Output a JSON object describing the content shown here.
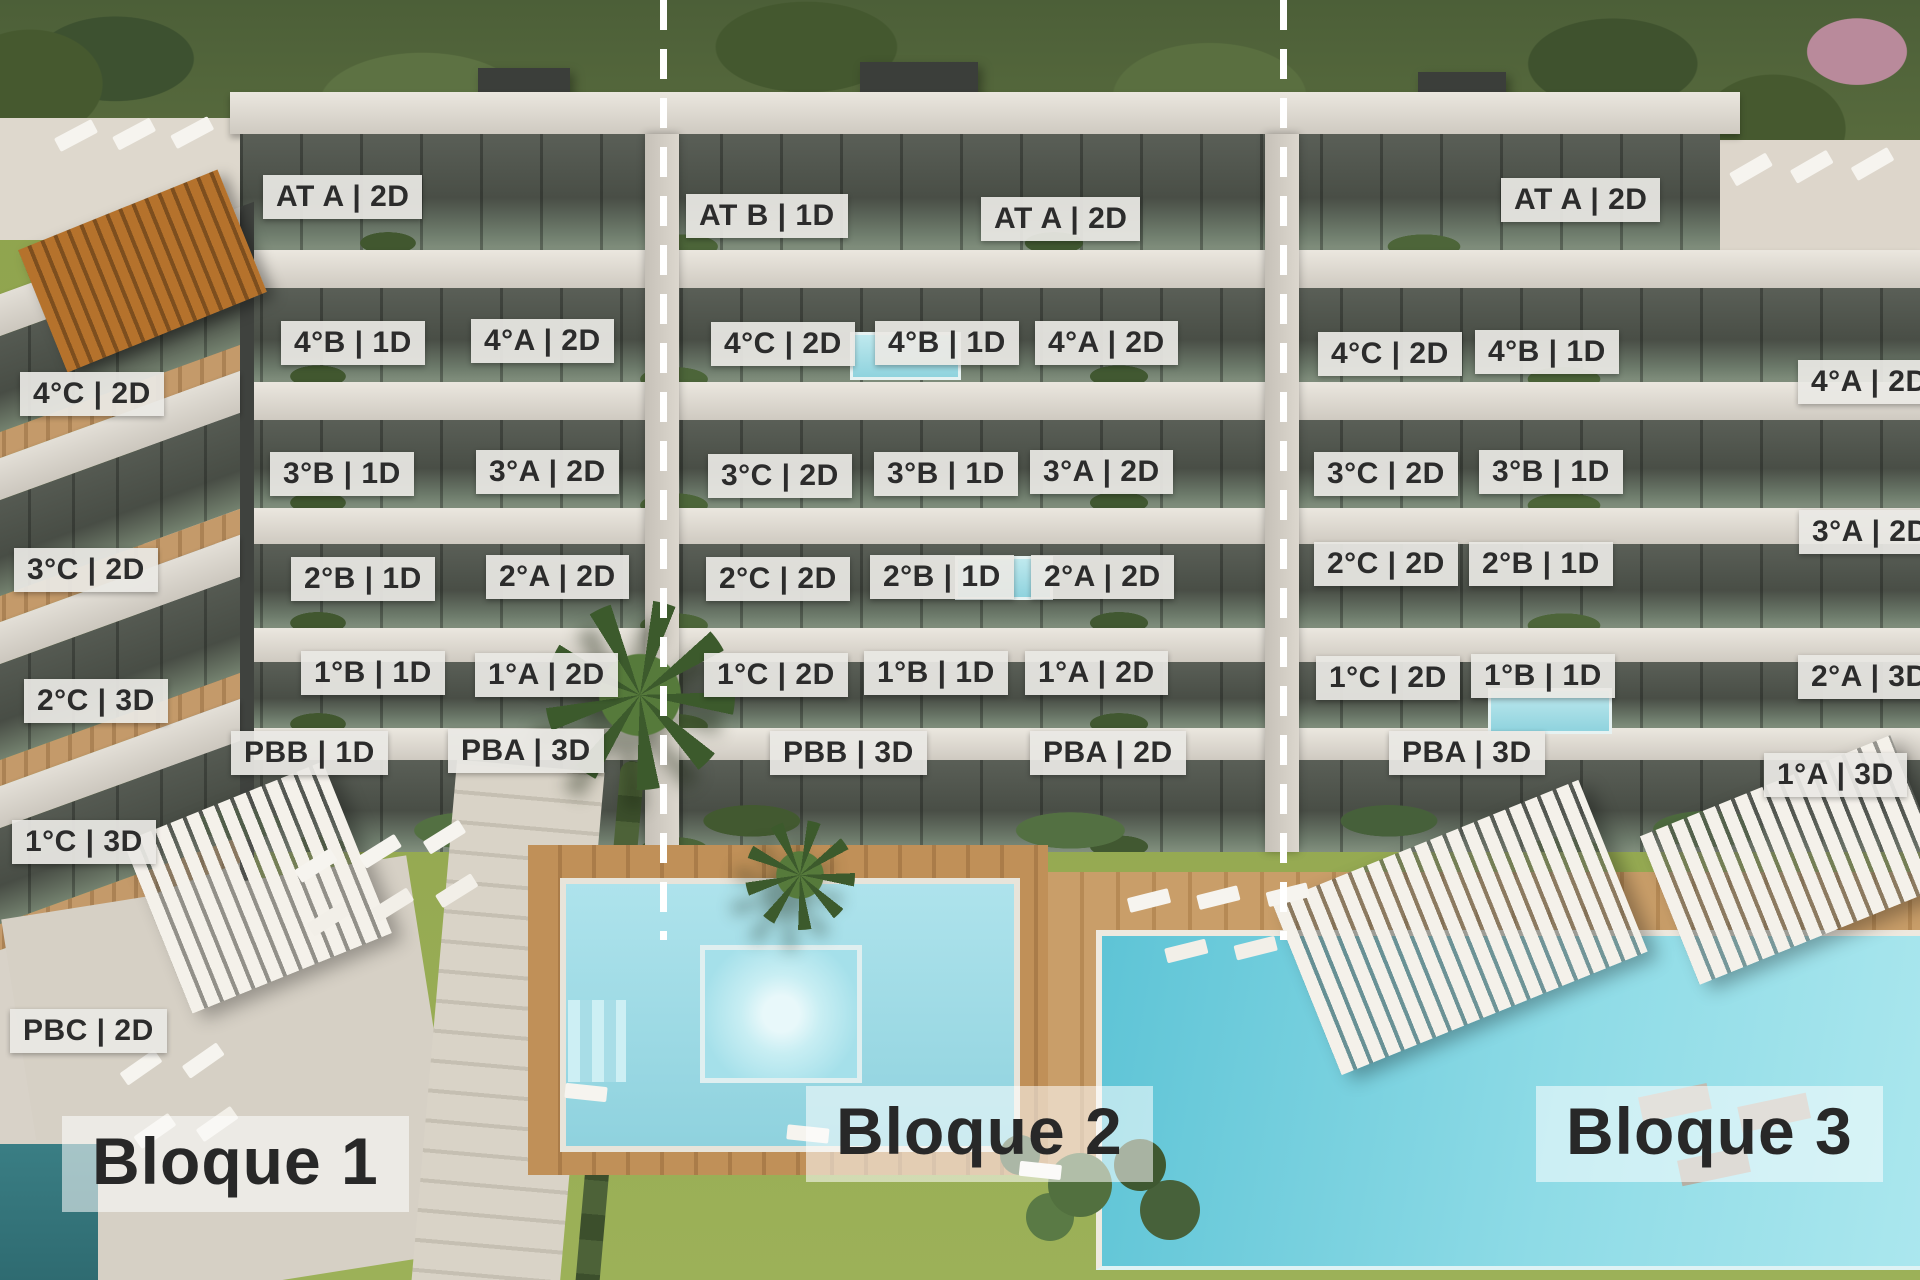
{
  "block_titles": [
    "Bloque 1",
    "Bloque 2",
    "Bloque 3"
  ],
  "colors": {
    "label_background": "#e9e8e4",
    "label_text": "#2c2c2c",
    "title_text": "#282828",
    "divider": "#ffffff",
    "lawn": "#93a750",
    "pool_water": "#8ed8e3",
    "wood_deck": "#bd8f5c",
    "facade_light": "#e2ded6",
    "facade_glass": "#4c5049"
  },
  "dividers": [
    {
      "x": 660
    },
    {
      "x": 1280
    }
  ],
  "unit_labels": [
    {
      "block": "Bloque 1",
      "text": "4°C | 2D",
      "x": 20,
      "y": 372
    },
    {
      "block": "Bloque 1",
      "text": "3°C | 2D",
      "x": 14,
      "y": 548
    },
    {
      "block": "Bloque 1",
      "text": "2°C | 3D",
      "x": 24,
      "y": 679
    },
    {
      "block": "Bloque 1",
      "text": "1°C | 3D",
      "x": 12,
      "y": 820
    },
    {
      "block": "Bloque 1",
      "text": "PBC | 2D",
      "x": 10,
      "y": 1009
    },
    {
      "block": "Bloque 1",
      "text": "AT A | 2D",
      "x": 263,
      "y": 175
    },
    {
      "block": "Bloque 1",
      "text": "4°B | 1D",
      "x": 281,
      "y": 321
    },
    {
      "block": "Bloque 1",
      "text": "4°A | 2D",
      "x": 471,
      "y": 319
    },
    {
      "block": "Bloque 1",
      "text": "3°B | 1D",
      "x": 270,
      "y": 452
    },
    {
      "block": "Bloque 1",
      "text": "3°A | 2D",
      "x": 476,
      "y": 450
    },
    {
      "block": "Bloque 1",
      "text": "2°B | 1D",
      "x": 291,
      "y": 557
    },
    {
      "block": "Bloque 1",
      "text": "2°A | 2D",
      "x": 486,
      "y": 555
    },
    {
      "block": "Bloque 1",
      "text": "1°B | 1D",
      "x": 301,
      "y": 651
    },
    {
      "block": "Bloque 1",
      "text": "1°A | 2D",
      "x": 475,
      "y": 653
    },
    {
      "block": "Bloque 1",
      "text": "PBB | 1D",
      "x": 231,
      "y": 731
    },
    {
      "block": "Bloque 1",
      "text": "PBA | 3D",
      "x": 448,
      "y": 729
    },
    {
      "block": "Bloque 2",
      "text": "AT B | 1D",
      "x": 686,
      "y": 194
    },
    {
      "block": "Bloque 2",
      "text": "AT A | 2D",
      "x": 981,
      "y": 197
    },
    {
      "block": "Bloque 2",
      "text": "4°C | 2D",
      "x": 711,
      "y": 322
    },
    {
      "block": "Bloque 2",
      "text": "4°B | 1D",
      "x": 875,
      "y": 321
    },
    {
      "block": "Bloque 2",
      "text": "4°A | 2D",
      "x": 1035,
      "y": 321
    },
    {
      "block": "Bloque 2",
      "text": "3°C | 2D",
      "x": 708,
      "y": 454
    },
    {
      "block": "Bloque 2",
      "text": "3°B | 1D",
      "x": 874,
      "y": 452
    },
    {
      "block": "Bloque 2",
      "text": "3°A | 2D",
      "x": 1030,
      "y": 450
    },
    {
      "block": "Bloque 2",
      "text": "2°C | 2D",
      "x": 706,
      "y": 557
    },
    {
      "block": "Bloque 2",
      "text": "2°B | 1D",
      "x": 870,
      "y": 555
    },
    {
      "block": "Bloque 2",
      "text": "2°A | 2D",
      "x": 1031,
      "y": 555
    },
    {
      "block": "Bloque 2",
      "text": "1°C | 2D",
      "x": 704,
      "y": 653
    },
    {
      "block": "Bloque 2",
      "text": "1°B | 1D",
      "x": 864,
      "y": 651
    },
    {
      "block": "Bloque 2",
      "text": "1°A | 2D",
      "x": 1025,
      "y": 651
    },
    {
      "block": "Bloque 2",
      "text": "PBB | 3D",
      "x": 770,
      "y": 731
    },
    {
      "block": "Bloque 2",
      "text": "PBA | 2D",
      "x": 1030,
      "y": 731
    },
    {
      "block": "Bloque 3",
      "text": "AT A | 2D",
      "x": 1501,
      "y": 178
    },
    {
      "block": "Bloque 3",
      "text": "4°C | 2D",
      "x": 1318,
      "y": 332
    },
    {
      "block": "Bloque 3",
      "text": "4°B | 1D",
      "x": 1475,
      "y": 330
    },
    {
      "block": "Bloque 3",
      "text": "4°A | 2D",
      "x": 1798,
      "y": 360,
      "clipped": true
    },
    {
      "block": "Bloque 3",
      "text": "3°C | 2D",
      "x": 1314,
      "y": 452
    },
    {
      "block": "Bloque 3",
      "text": "3°B | 1D",
      "x": 1479,
      "y": 450
    },
    {
      "block": "Bloque 3",
      "text": "3°A | 2D",
      "x": 1799,
      "y": 510,
      "clipped": true
    },
    {
      "block": "Bloque 3",
      "text": "2°C | 2D",
      "x": 1314,
      "y": 542
    },
    {
      "block": "Bloque 3",
      "text": "2°B | 1D",
      "x": 1469,
      "y": 542
    },
    {
      "block": "Bloque 3",
      "text": "2°A | 3D",
      "x": 1798,
      "y": 655,
      "clipped": true
    },
    {
      "block": "Bloque 3",
      "text": "1°C | 2D",
      "x": 1316,
      "y": 656
    },
    {
      "block": "Bloque 3",
      "text": "1°B | 1D",
      "x": 1471,
      "y": 654
    },
    {
      "block": "Bloque 3",
      "text": "PBA | 3D",
      "x": 1389,
      "y": 731
    },
    {
      "block": "Bloque 3",
      "text": "1°A | 3D",
      "x": 1764,
      "y": 753
    }
  ]
}
